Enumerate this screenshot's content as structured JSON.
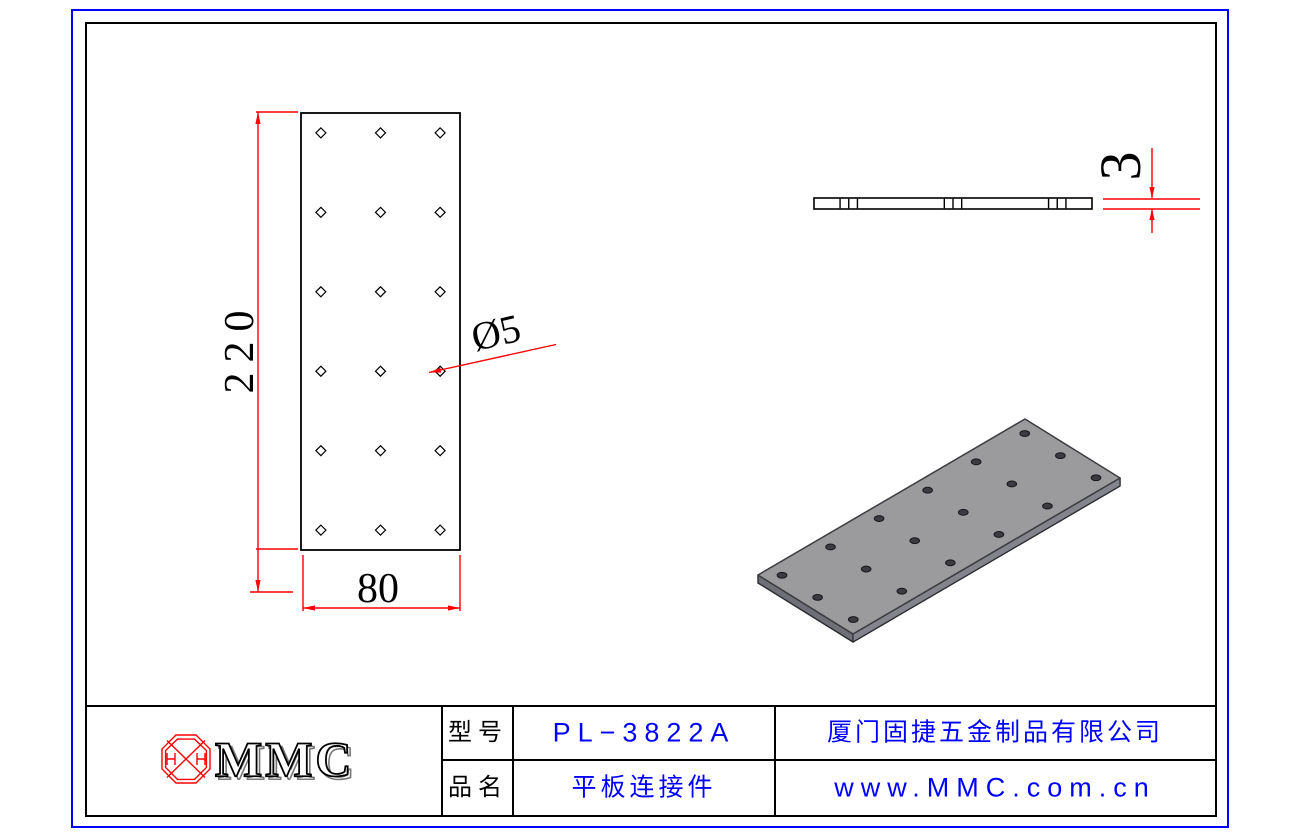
{
  "colors": {
    "dimension_red": "#ff0000",
    "outer_border_blue": "#0000ff",
    "title_value_blue": "#0000ff",
    "line_black": "#000000",
    "iso_top_gray": "#9b9b9d",
    "iso_side_short_gray": "#6f6f77",
    "iso_side_long_gray": "#84848c",
    "iso_hole_dark": "#3b3b41"
  },
  "part": {
    "width_mm": 80,
    "length_mm": 220,
    "thickness_mm": 3,
    "hole_d_mm": 5,
    "hole_cols": 3,
    "hole_rows": 6,
    "hole_pitch_x_mm": 30,
    "hole_pitch_y_mm": 40,
    "edge_margin_mm": 10
  },
  "dimensions": {
    "length_label": "220",
    "width_label": "80",
    "hole_label": "Ø5",
    "thickness_label": "3"
  },
  "title_block": {
    "logo_text": "MMC",
    "model_label": "型号",
    "model_value": "PL−3822A",
    "name_label": "品名",
    "name_value": "平板连接件",
    "company": "厦门固捷五金制品有限公司",
    "website": "www.MMC.com.cn"
  }
}
